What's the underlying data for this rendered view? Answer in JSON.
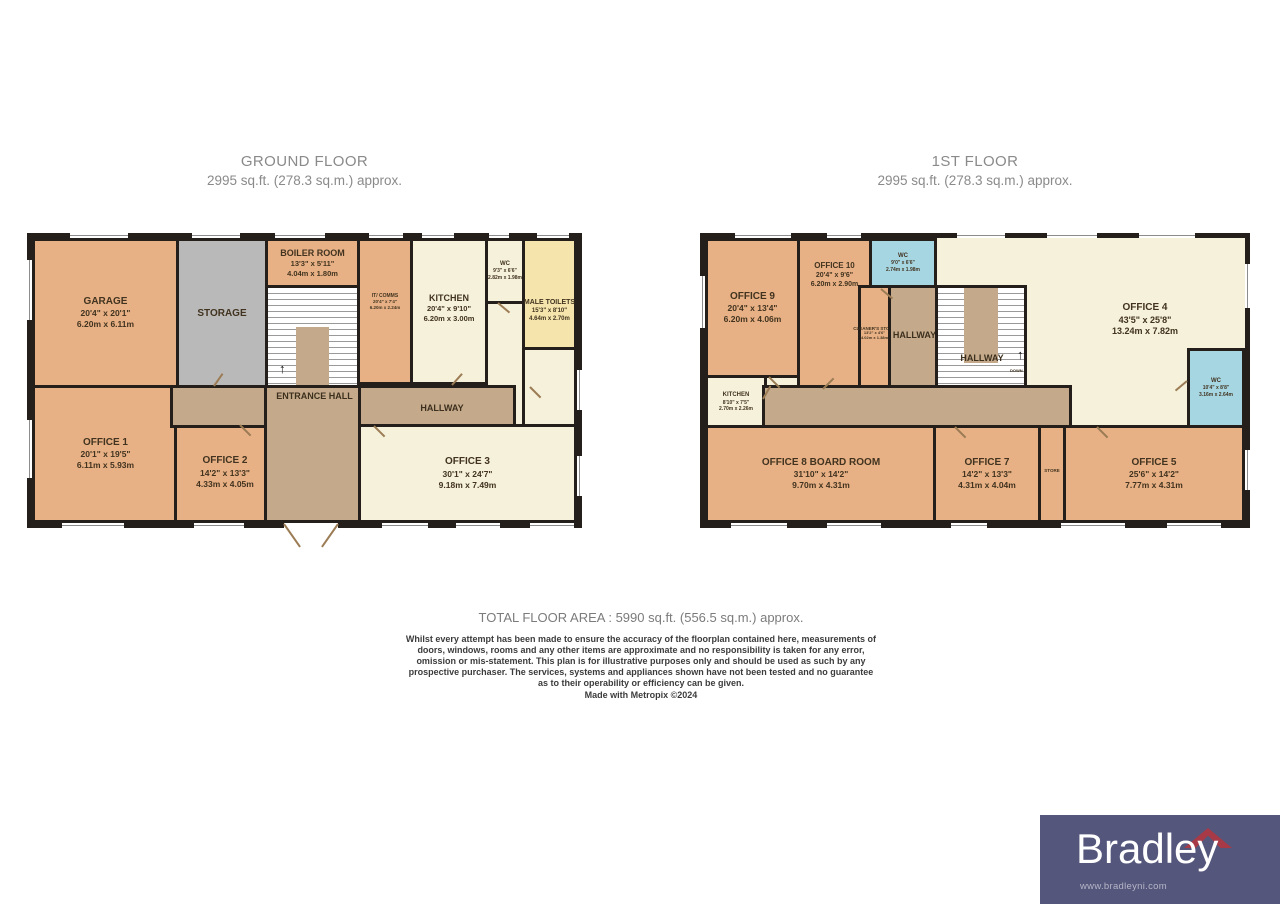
{
  "titles": {
    "ground_name": "GROUND FLOOR",
    "ground_area": "2995 sq.ft. (278.3 sq.m.) approx.",
    "first_name": "1ST FLOOR",
    "first_area": "2995 sq.ft. (278.3 sq.m.) approx."
  },
  "ground": {
    "rooms": {
      "garage": {
        "name": "GARAGE",
        "ft": "20'4\" x 20'1\"",
        "m": "6.20m x 6.11m"
      },
      "storage": {
        "name": "STORAGE"
      },
      "boiler_room": {
        "name": "BOILER ROOM",
        "ft": "13'3\" x 5'11\"",
        "m": "4.04m x 1.80m"
      },
      "entrance_hall": {
        "name": "ENTRANCE HALL"
      },
      "it_comms": {
        "name": "IT/ COMMS",
        "ft": "20'4\" x 7'4\"",
        "m": "6.20m x 2.24m"
      },
      "kitchen": {
        "name": "KITCHEN",
        "ft": "20'4\" x 9'10\"",
        "m": "6.20m x 3.00m"
      },
      "wc": {
        "name": "WC",
        "ft": "9'3\" x 6'6\"",
        "m": "2.82m x 1.98m"
      },
      "male_toilets": {
        "name": "MALE TOILETS",
        "ft": "15'3\" x 8'10\"",
        "m": "4.64m x 2.70m"
      },
      "hallway": {
        "name": "HALLWAY"
      },
      "office1": {
        "name": "OFFICE 1",
        "ft": "20'1\" x 19'5\"",
        "m": "6.11m x 5.93m"
      },
      "office2": {
        "name": "OFFICE 2",
        "ft": "14'2\" x 13'3\"",
        "m": "4.33m x 4.05m"
      },
      "office3": {
        "name": "OFFICE 3",
        "ft": "30'1\" x 24'7\"",
        "m": "9.18m x 7.49m"
      }
    }
  },
  "first": {
    "rooms": {
      "office9": {
        "name": "OFFICE 9",
        "ft": "20'4\" x 13'4\"",
        "m": "6.20m x 4.06m"
      },
      "office10": {
        "name": "OFFICE 10",
        "ft": "20'4\" x 9'6\"",
        "m": "6.20m x 2.90m"
      },
      "wc_top": {
        "name": "WC",
        "ft": "9'0\" x 6'6\"",
        "m": "2.74m x 1.98m"
      },
      "cleaners_store": {
        "name": "CLEANER'S STORE",
        "ft": "13'2\" x 4'6\"",
        "m": "4.02m x 1.38m"
      },
      "hallway_left": {
        "name": "HALLWAY"
      },
      "hallway_stairs": {
        "name": "HALLWAY",
        "down": "DOWN"
      },
      "office4": {
        "name": "OFFICE 4",
        "ft": "43'5\" x 25'8\"",
        "m": "13.24m x 7.82m"
      },
      "wc_right": {
        "name": "WC",
        "ft": "10'4\" x 8'8\"",
        "m": "3.16m x 2.64m"
      },
      "kitchen": {
        "name": "KITCHEN",
        "ft": "8'10\" x 7'5\"",
        "m": "2.70m x 2.26m"
      },
      "office8": {
        "name": "OFFICE 8 BOARD ROOM",
        "ft": "31'10\" x 14'2\"",
        "m": "9.70m x 4.31m"
      },
      "office7": {
        "name": "OFFICE 7",
        "ft": "14'2\" x 13'3\"",
        "m": "4.31m x 4.04m"
      },
      "store": {
        "name": "STORE"
      },
      "office5": {
        "name": "OFFICE 5",
        "ft": "25'6\" x 14'2\"",
        "m": "7.77m x 4.31m"
      }
    }
  },
  "footer": {
    "total": "TOTAL FLOOR AREA : 5990 sq.ft. (556.5 sq.m.) approx.",
    "disclaimer": "Whilst every attempt has been made to ensure the accuracy of the floorplan contained here, measurements of doors, windows, rooms and any other items are approximate and no responsibility is taken for any error, omission or mis-statement. This plan is for illustrative purposes only and should be used as such by any prospective purchaser. The services, systems and appliances shown have not been tested and no guarantee as to their operability or efficiency can be given.",
    "made_with": "Made with Metropix ©2024"
  },
  "logo": {
    "brand": "Bradley",
    "website": "www.bradleyni.com"
  },
  "colors": {
    "room_orange": "#e8b185",
    "room_cream": "#f6f1da",
    "room_gray": "#b9b9b9",
    "room_yellow": "#f5e5ac",
    "room_blue": "#a7d6e3",
    "hall_brown": "#c4aa8b",
    "wall": "#241f1a",
    "logo_purple": "#54567c",
    "logo_roof_red": "#a73a46"
  }
}
